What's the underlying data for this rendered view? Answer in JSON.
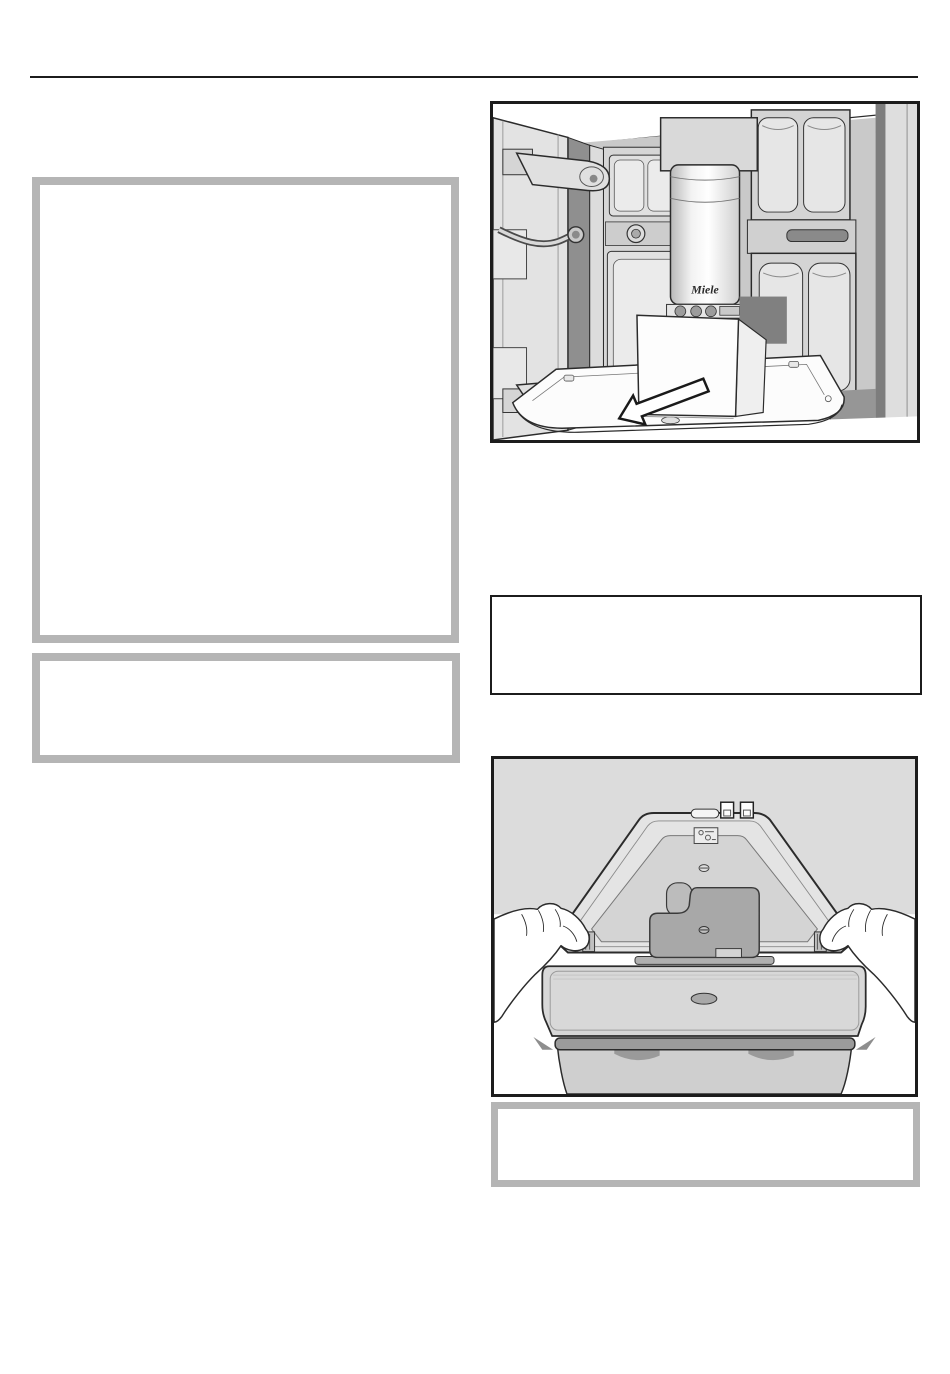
{
  "page": {
    "background": "#ffffff"
  },
  "header": {
    "rule_color": "#1c1c1c"
  },
  "callouts": {
    "border_color": "#b5b5b5"
  },
  "note_box": {
    "border_color": "#1c1c1c"
  },
  "figures": {
    "border_color": "#1c1c1c",
    "filter_removal": {
      "brand_label": "Miele"
    }
  }
}
